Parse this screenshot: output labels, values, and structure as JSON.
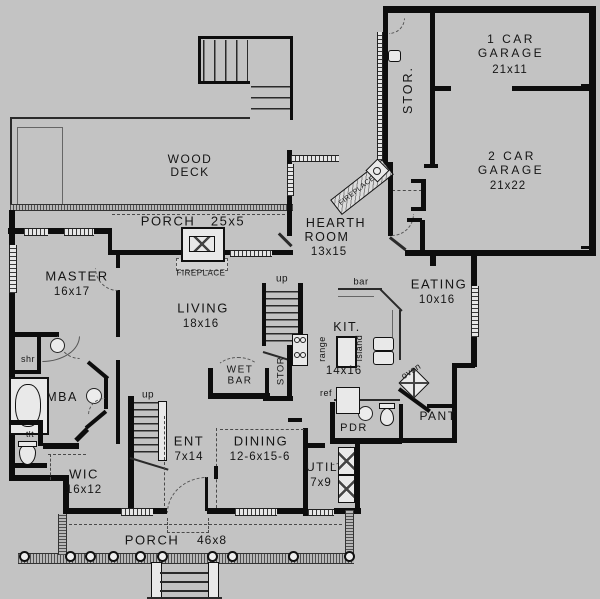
{
  "colors": {
    "background": "#c3c3c3",
    "wall": "#0d0d0d"
  },
  "rooms": {
    "wood_deck": {
      "line1": "WOOD",
      "line2": "DECK"
    },
    "porch_upper": {
      "name": "PORCH",
      "dims": "25x5"
    },
    "garage_1car": {
      "line1": "1 CAR",
      "line2": "GARAGE",
      "dims": "21x11"
    },
    "garage_2car": {
      "line1": "2 CAR",
      "line2": "GARAGE",
      "dims": "21x22"
    },
    "storage_garage": {
      "name": "STOR."
    },
    "hearth_room": {
      "line1": "HEARTH",
      "line2": "ROOM",
      "dims": "13x15"
    },
    "master": {
      "name": "MASTER",
      "dims": "16x17"
    },
    "living": {
      "name": "LIVING",
      "dims": "18x16"
    },
    "eating": {
      "name": "EATING",
      "dims": "10x16"
    },
    "kitchen": {
      "name": "KIT.",
      "dims": "14x16"
    },
    "wet_bar": {
      "line1": "WET",
      "line2": "BAR"
    },
    "storage_stairs": {
      "name": "STOR"
    },
    "master_bath": {
      "name": "MBA"
    },
    "shower": {
      "name": "shr"
    },
    "toilet_room": {
      "name": "tlt"
    },
    "wic": {
      "name": "WIC",
      "dims": "16x12"
    },
    "entry": {
      "name": "ENT",
      "dims": "7x14"
    },
    "dining": {
      "name": "DINING",
      "dims": "12-6x15-6"
    },
    "utility": {
      "name": "UTIL",
      "dims": "7x9"
    },
    "pantry": {
      "name": "PANT"
    },
    "powder": {
      "name": "PDR"
    },
    "porch_lower": {
      "name": "PORCH",
      "dims": "46x8"
    }
  },
  "fixtures": {
    "fireplace_living": "FIREPLACE",
    "fireplace_hearth": "FIREPLACE",
    "bar": "bar",
    "range": "range",
    "island": "island",
    "fridge": "ref",
    "oven": "oven",
    "stairs_up_center": "up",
    "stairs_up_entry": "up"
  }
}
